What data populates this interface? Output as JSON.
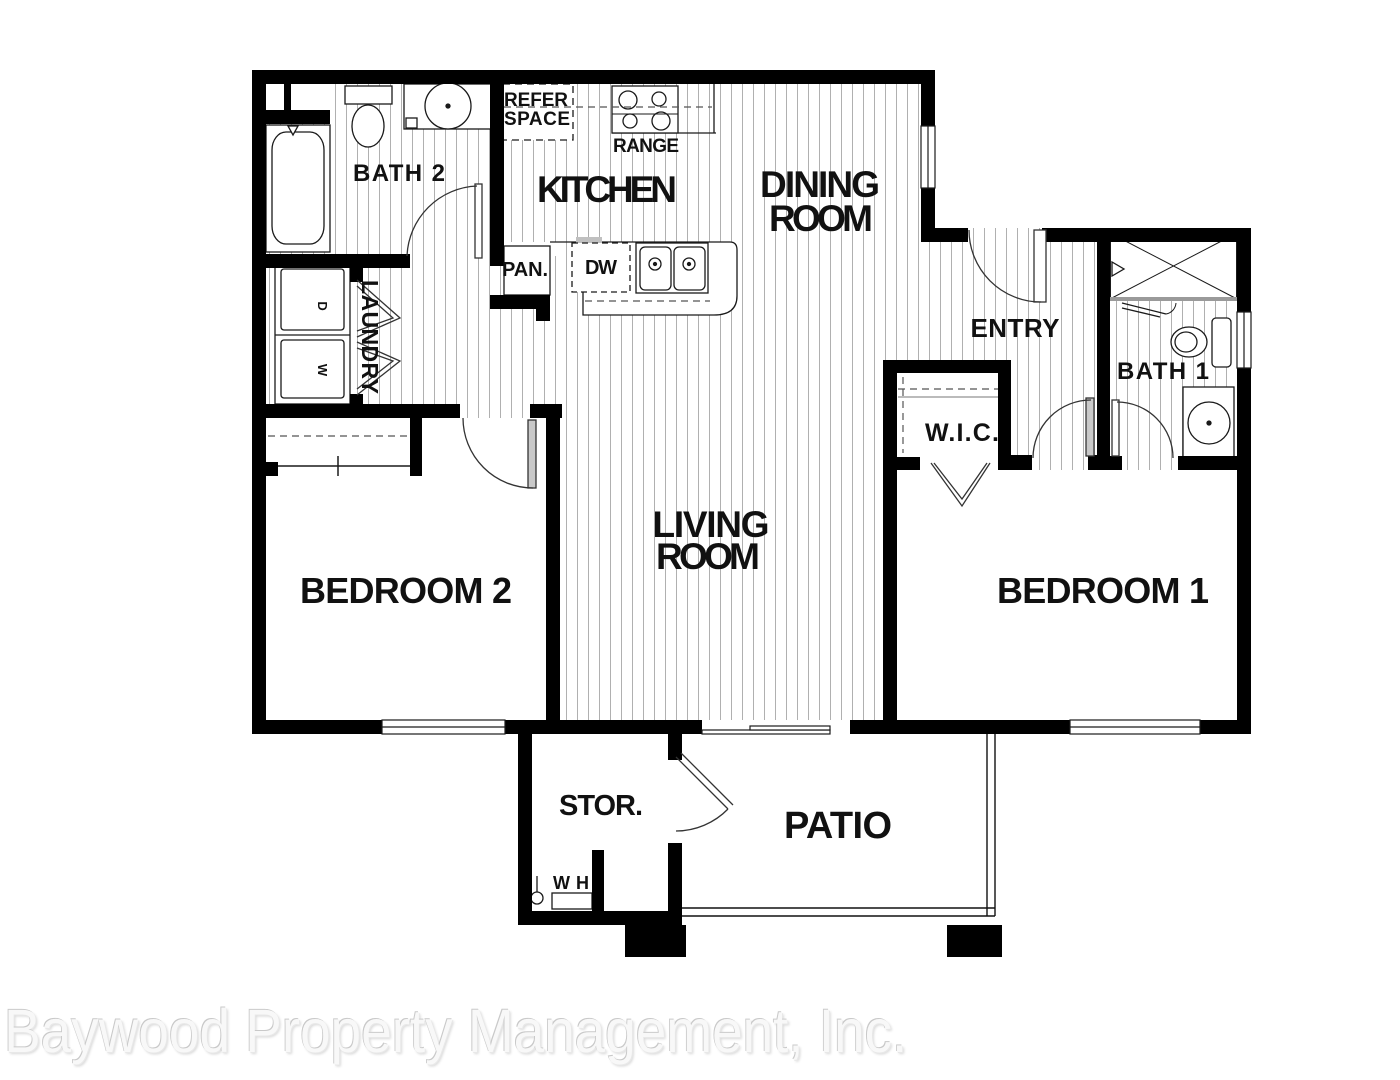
{
  "watermark": {
    "text": "Baywood Property Management, Inc."
  },
  "rooms": {
    "bath2": "BATH 2",
    "kitchen": "KITCHEN",
    "dining_line1": "DINING",
    "dining_line2": "ROOM",
    "entry": "ENTRY",
    "bath1": "BATH 1",
    "laundry": "LAUNDRY",
    "wic": "W.I.C.",
    "living_line1": "LIVING",
    "living_line2": "ROOM",
    "bedroom2": "BEDROOM 2",
    "bedroom1": "BEDROOM 1",
    "storage": "STOR.",
    "patio": "PATIO"
  },
  "fixtures": {
    "refer_line1": "REFER",
    "refer_line2": "SPACE",
    "range": "RANGE",
    "pantry": "PAN.",
    "dishwasher": "DW",
    "water_heater": "WH",
    "dryer": "D",
    "washer": "W"
  },
  "colors": {
    "wall": "#000000",
    "hatch": "#b0b0b0",
    "label": "#111111",
    "watermark_text": "#f8f8f8"
  }
}
